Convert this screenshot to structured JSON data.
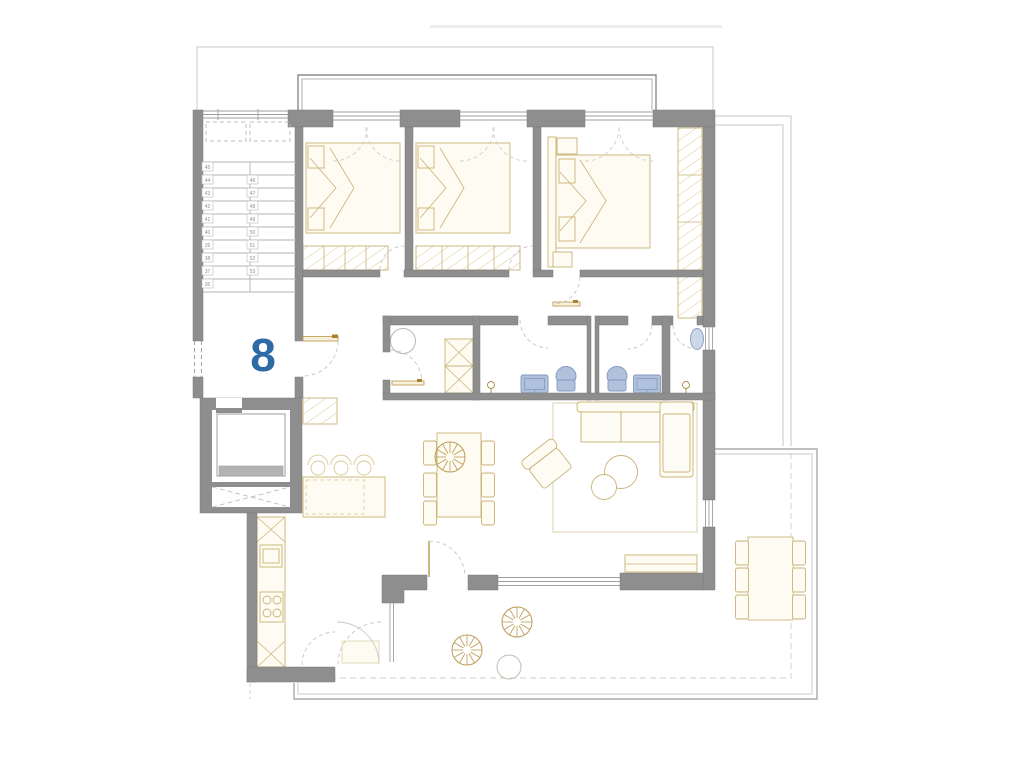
{
  "plan": {
    "unit_number": "8",
    "unit_number_color": "#2e6ba6"
  },
  "stairs": {
    "left_run": [
      "45",
      "44",
      "43",
      "42",
      "41",
      "40",
      "39",
      "38",
      "37",
      "36"
    ],
    "right_run": [
      "46",
      "47",
      "48",
      "49",
      "50",
      "51",
      "52",
      "53"
    ]
  },
  "colors": {
    "background": "#ffffff",
    "wall_fill": "#8e8e8e",
    "wall_outline": "#7b7b7b",
    "thin_line": "#a3a3a3",
    "faint_line": "#c9c9c9",
    "furniture_stroke": "#c9b274",
    "furniture_fill": "#fdfbf2",
    "fixture_fill": "#b0c1dc",
    "fixture_stroke": "#8399bd",
    "plant_stroke": "#bd9c55",
    "stair_number_color": "#8f8f8f"
  }
}
